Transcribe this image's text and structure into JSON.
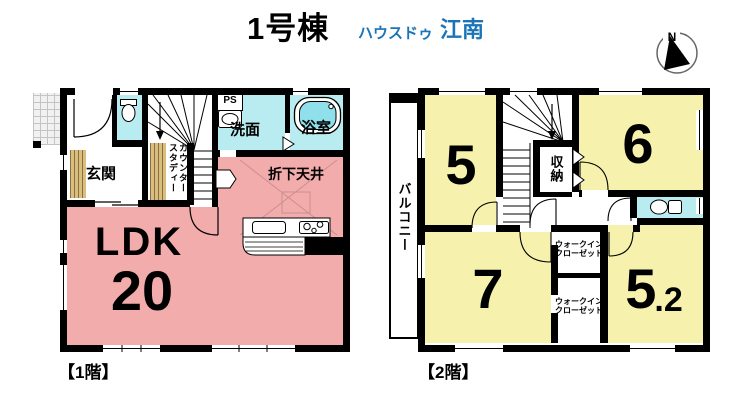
{
  "header": {
    "title": "1号棟",
    "brand_name": "ハウスドゥ",
    "brand_area": "江南"
  },
  "compass": {
    "north": "N"
  },
  "floor1": {
    "caption": "【1階】",
    "labels": {
      "genkan": "玄関",
      "washroom": "洗面",
      "bathroom": "浴室",
      "ps": "PS",
      "study_line1": "スタディー",
      "study_line2": "カウンター",
      "dropped_ceiling": "折下天井",
      "ldk": "LDK",
      "ldk_size": "20"
    }
  },
  "floor2": {
    "caption": "【2階】",
    "labels": {
      "balcony": "バルコニー",
      "room5": "5",
      "room6": "6",
      "room7": "7",
      "room52_int": "5",
      "room52_dec": ".2",
      "storage": "収納",
      "wic_line1": "ウォークイン",
      "wic_line2": "クローゼット"
    }
  },
  "colors": {
    "pink": "#F3ACAC",
    "yellow": "#F6F2AD",
    "cyan": "#B9ECF1",
    "water": "#8FE0EA",
    "wood": "#D9BE7E",
    "blue": "#1B74B8"
  }
}
